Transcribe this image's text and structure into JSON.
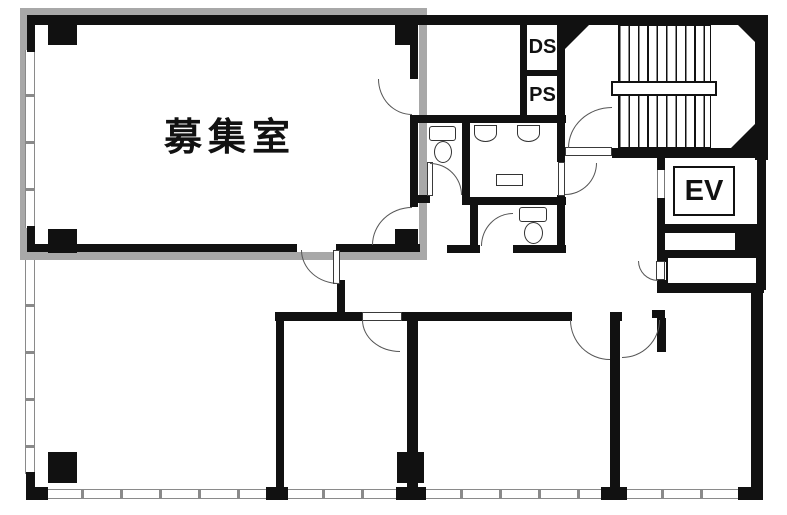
{
  "floorplan": {
    "labels": {
      "vacant_room": "募集室",
      "duct_space": "DS",
      "pipe_space": "PS",
      "elevator": "EV"
    },
    "colors": {
      "wall": "#111111",
      "vacant_room_highlight": "#a8a8a8",
      "window_line": "#8a8a8a",
      "door_arc": "#555555",
      "background": "#ffffff"
    }
  }
}
